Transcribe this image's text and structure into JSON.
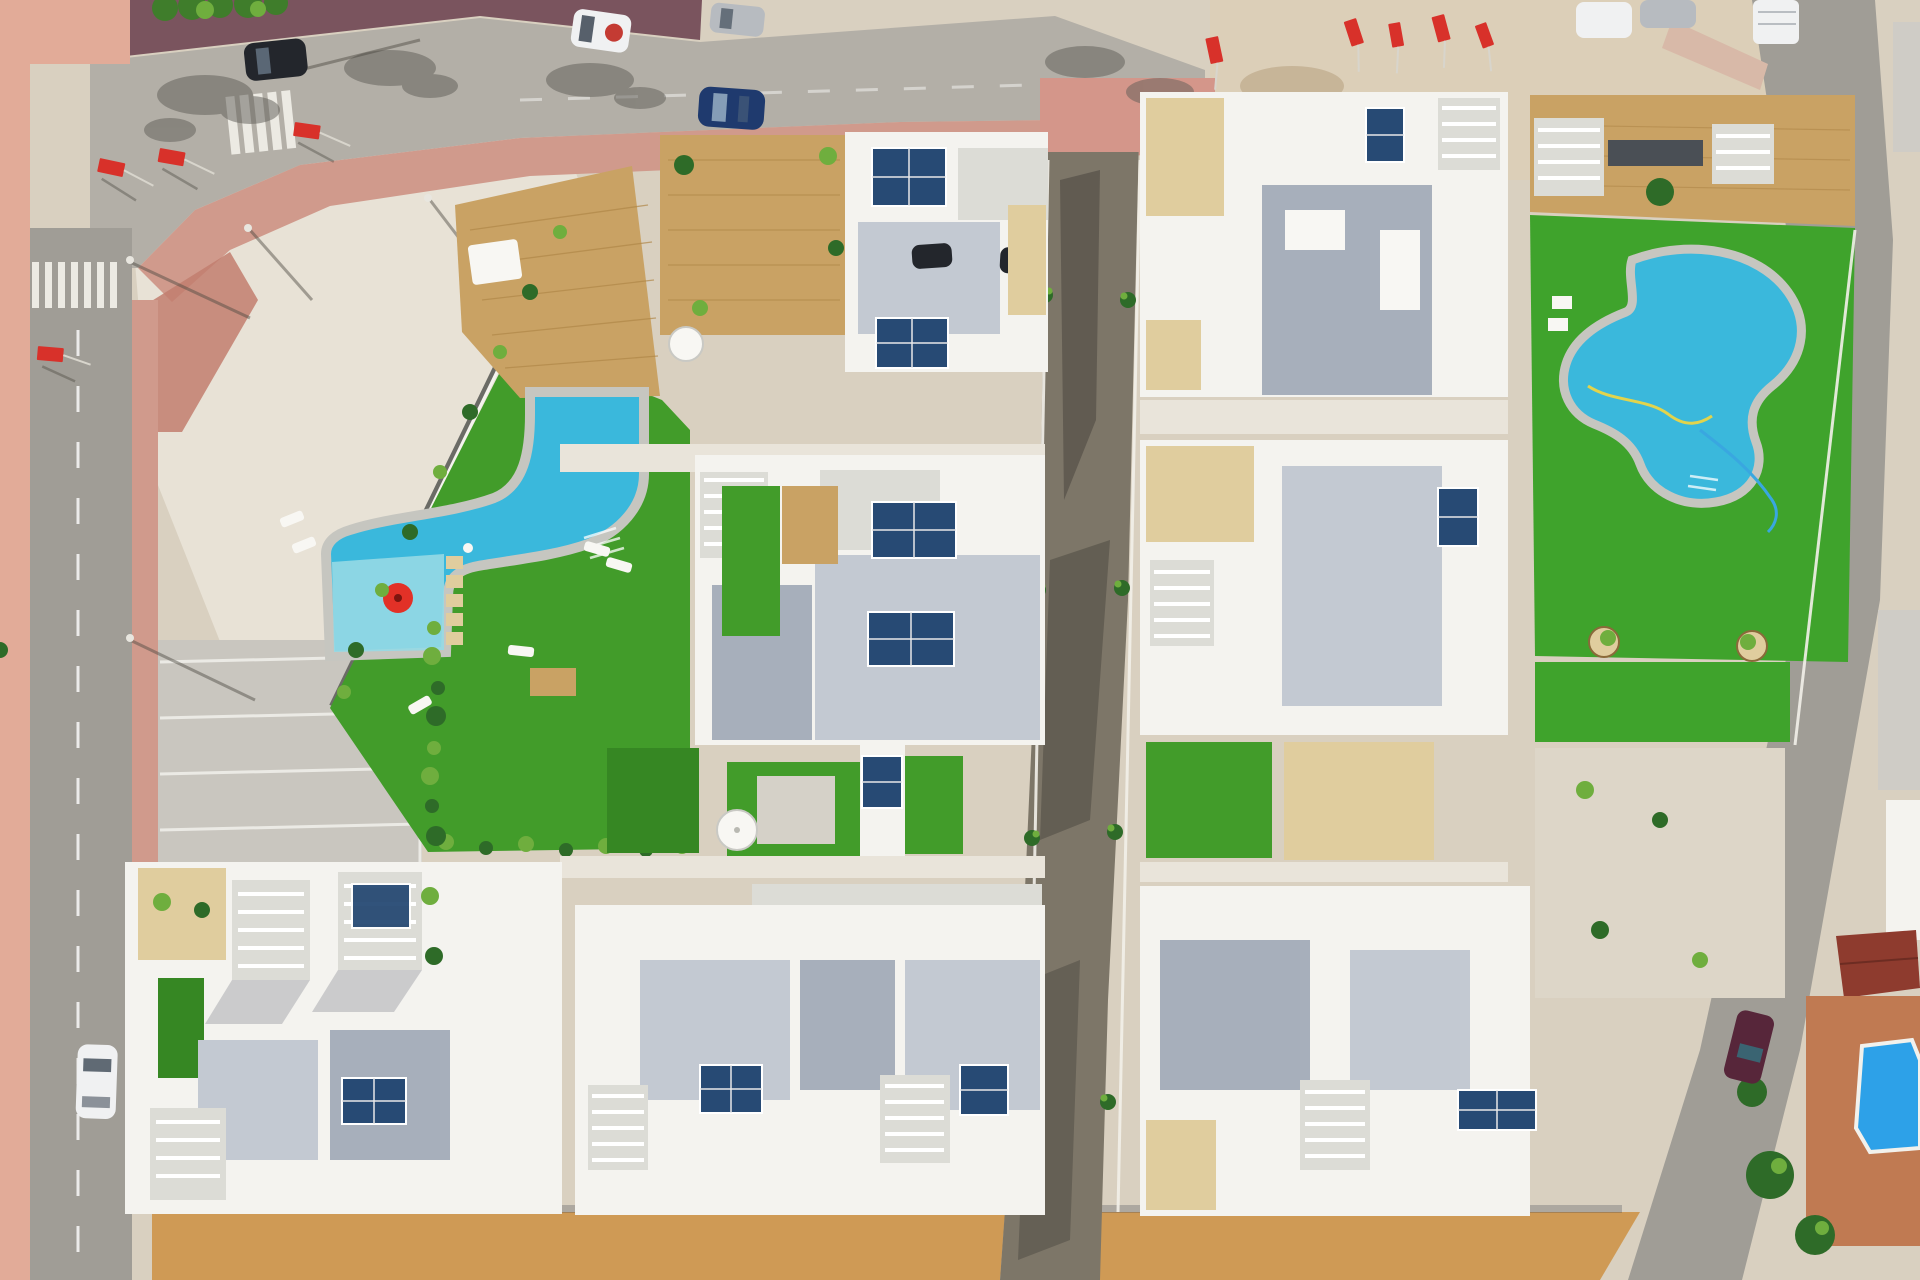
{
  "scene": {
    "type": "aerial-drone-photo",
    "view": "top-down, midday sun",
    "description": "Aerial view of a newly built white-villa residential complex with two communal turquoise pools on artificial lawns, roof solar panels and pergolas, bordered by an asphalt road with parked cars at top, a road with crosswalks at left, a central unpaved construction road with palm saplings, a diagonal road and an older terracotta neighbourhood with a small blue pool at bottom right, and an orange dirt strip along the bottom."
  },
  "palette": {
    "sand": "#d9d0c0",
    "gravel": "#e8e2d6",
    "dirt": "#cf9a55",
    "road": "#b3afa7",
    "road_dark": "#a09d96",
    "dirt_road": "#7d7668",
    "dirt_road_dark": "#4e4a42",
    "sidewalk_pink": "#d09a8c",
    "sidewalk_salmon": "#e2ab98",
    "sidewalk_maroon": "#7a545e",
    "crossing_pink": "#d4968a",
    "lawn": "#429c2a",
    "lawn_dark": "#368723",
    "lawn_right": "#3fa32c",
    "pool_water": "#3ab8dc",
    "pool_shallow": "#96d9e4",
    "pool_coping": "#c6c6c0",
    "pool_blue_old": "#2da1e8",
    "deck": "#c9a264",
    "deck_dark": "#b08748",
    "villa": "#f4f3ef",
    "villa_shade": "#e9e4da",
    "roof_gray": "#c3c9d2",
    "roof_gray_dark": "#a7afbb",
    "roof_light": "#dcdcd6",
    "tile_beige": "#e0cd9e",
    "solar": "#274a74",
    "solar_dark": "#1c3457",
    "shadow": "#3c4050",
    "flag_red": "#d8312a",
    "hedge": "#3f7d2b",
    "plant": "#6fae3e",
    "palm_dark": "#2e6b28",
    "car_white": "#f0f1f2",
    "car_silver": "#b7bbc0",
    "car_blue": "#1f3a6e",
    "car_dark": "#23262c",
    "car_maroon": "#57263a",
    "terracotta": "#c07a52",
    "roof_red": "#8e3b2e",
    "old_bldg": "#cfccc6"
  },
  "objects": {
    "pools": [
      {
        "name": "left communal pool",
        "shape": "curved free-form",
        "water": "turquoise",
        "features": [
          "children's section",
          "stepping stones",
          "red parasol",
          "white sun loungers",
          "timber platform"
        ]
      },
      {
        "name": "right communal pool",
        "shape": "kidney",
        "water": "turquoise",
        "features": [
          "garden hose on lawn",
          "white pads",
          "planters"
        ]
      },
      {
        "name": "old town pool",
        "shape": "rectangular with cut corners",
        "water": "deep blue"
      }
    ],
    "vehicles": [
      {
        "color": "white hatchback with red roof disc",
        "location": "top road"
      },
      {
        "color": "silver",
        "location": "top road"
      },
      {
        "color": "dark blue",
        "location": "top road"
      },
      {
        "color": "dark gray",
        "location": "top road near hedge"
      },
      {
        "color": "white",
        "location": "left road, parked"
      },
      {
        "color": "white van",
        "location": "top right"
      },
      {
        "color": "silver",
        "location": "top right sand"
      },
      {
        "color": "white",
        "location": "top right sand"
      },
      {
        "color": "maroon",
        "location": "right diagonal road"
      }
    ],
    "flags": {
      "count": 9,
      "color": "red",
      "style": "promotional banner flags on white poles"
    },
    "villas": {
      "count": 9,
      "style": "white modern flat roofs, blue-gray terraces, white pergolas, rooftop solar panels"
    },
    "roads": [
      "top asphalt road with lane dashes",
      "left road with dashed centerline and two crosswalks",
      "central unpaved construction road with palm saplings",
      "right diagonal road"
    ],
    "ground": [
      "white gravel plaza top-left",
      "sand and gravel lots",
      "gray parking bays with white lines",
      "orange dirt strip at bottom",
      "terracotta courtyard bottom-right"
    ]
  }
}
